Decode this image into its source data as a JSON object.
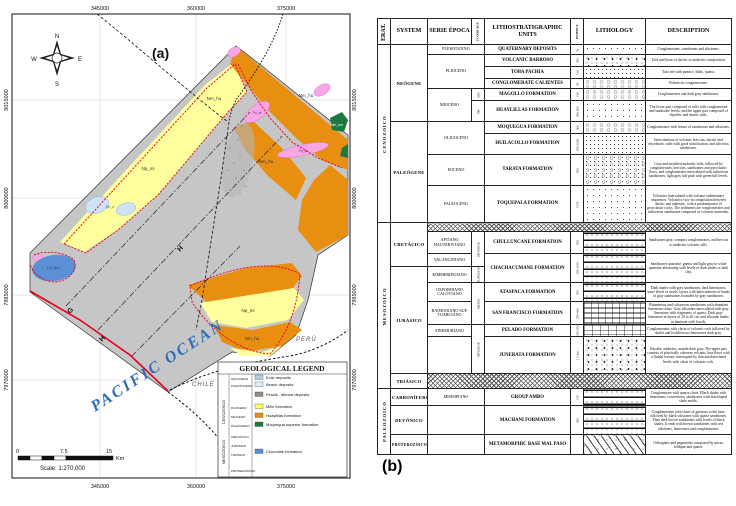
{
  "panel_a": {
    "label": "(a)",
    "compass": {
      "n": "N",
      "s": "S",
      "e": "E",
      "w": "W"
    },
    "coords_top": [
      "345000",
      "360000",
      "375000"
    ],
    "coords_bottom": [
      "345000",
      "360000",
      "375000"
    ],
    "coords_left": [
      "8015000",
      "8000000",
      "7985000",
      "7970000"
    ],
    "coords_right": [
      "8015000",
      "8000000",
      "7985000",
      "7970000"
    ],
    "ocean_label": "PACIFIC OCEAN",
    "chile_label": "CHILE",
    "peru_label": "PERÚ",
    "section_letters": [
      "G",
      "H",
      "H"
    ],
    "map_labels": [
      "Np_mi",
      "Nm_hu",
      "Nm_hu",
      "Nm_hu",
      "Po_ta",
      "Po_ta",
      "TrJ_cho",
      "Qh_e",
      "Np_mi",
      "Nm_hu",
      "Nm_mo"
    ],
    "scale": {
      "zero": "0",
      "mid": "7.5",
      "end": "15",
      "unit": "Km",
      "text": "Scale: 1:270,000"
    },
    "legend": {
      "title": "GEOLOGICAL LEGEND",
      "eras": [
        "CENOZOICO",
        "MESOZOICO",
        "PROTEROZOICO"
      ],
      "series": [
        "HOLOCENO",
        "PLEISTOCENO",
        "PLIOCENO",
        "MIOCENO",
        "PALEÓGENO",
        "CRETÁCICO",
        "JURÁSICO",
        "TRIÁSICO"
      ],
      "entries": [
        {
          "code": "Qh_e",
          "label": "Eolic deposits",
          "color": "#aed4f0"
        },
        {
          "code": "Qh_pl",
          "label": "Beach deposits",
          "color": "#dfeef9"
        },
        {
          "code": "Qpl_al",
          "label": "Fluvial - alluvial deposits",
          "color": "#8f8f8f"
        },
        {
          "code": "Np_mi",
          "label": "Millo formation",
          "color": "#ffff66"
        },
        {
          "code": "Nm_hu",
          "label": "Huaylillas formation",
          "color": "#e88f12"
        },
        {
          "code": "Nm_mo",
          "label": "Moquegua superior formation",
          "color": "#1d7a3c"
        },
        {
          "code": "TrJ_cho",
          "label": "Chocolate formation",
          "color": "#5b8fd6"
        }
      ]
    }
  },
  "panel_b": {
    "label": "(b)",
    "headers": {
      "era": "ERAT.",
      "system": "SYSTEM",
      "serie": "SERIE ÉPOCA",
      "floor": "FLOOR AGE",
      "units": "LITHOSTRATIGRAPHIC UNITS",
      "potency": "POTENCY",
      "lithology": "LITHOLOGY",
      "description": "DESCRIPTION"
    },
    "rows": [
      {
        "era": "CENOZOICO",
        "system": "NEÓGENE",
        "serie": "PLEISTOCENO",
        "unit": "QUATERNARY DEPOSITS",
        "potency": "50",
        "lithology": "dots-sparse",
        "description": "Conglomerates, sandstones and siltstones."
      },
      {
        "serie": "PLIOCENO",
        "unit": "VOLCANIC BARROSO",
        "potency": "300",
        "lithology": "volcanic",
        "description": "Tufa and lavas of dacitic to andesitic composition."
      },
      {
        "unit": "TOBA PACHIA",
        "potency": "100",
        "lithology": "dots",
        "description": "Tufa red with pumice, lithic, quartz."
      },
      {
        "unit": "CONGLOMERATE CALIENTES",
        "potency": "50",
        "lithology": "conglomerate",
        "description": "Polimictic conglomerates."
      },
      {
        "serie": "MIOCENO",
        "floor": "SUP.",
        "unit": "MAGOLLO FORMATION",
        "potency": "100",
        "lithology": "conglomerate",
        "description": "Conglomerates and dark gray sandstones."
      },
      {
        "floor": "INF.",
        "unit": "HUAYLILLAS FORMATION",
        "potency": "300-600",
        "lithology": "dots-sparse",
        "description": "The lower part composed of tuffs with conglomerate and sandstone levels, and the upper part composed of rhyolitic and dacitic tuffs."
      },
      {
        "system": "PALEÓGENE",
        "serie": "OLIGOCENO",
        "unit": "MOQUEGUA FORMATION",
        "potency": "400",
        "lithology": "conglomerate",
        "description": "Conglomerates with lenses of sandstones and siltstones."
      },
      {
        "unit": "HUILACOLLO FORMATION",
        "potency": "600-1000",
        "lithology": "dots",
        "description": "Intercalations of volcanic breccias, dacitic and rhyodacitic tuffs with good stratification, and siliceous sandstones."
      },
      {
        "serie": "EOCENO",
        "unit": "TARATA FORMATION",
        "potency": "900",
        "lithology": "conglomerate-dots",
        "description": "Gray and stratified andesitic tuffs, followed by conglomerates, breccias, sandstones and pyroclastic flows, and conglomerates intercalated with tuffaceous sandstones, light gray tuff pink with green tuff levels."
      },
      {
        "serie": "PALEOCENO",
        "unit": "TOQUEPALA FORMATION",
        "potency": "1570",
        "lithology": "dots-sparse",
        "description": "Volcanics intercalated with volcano-sedimentary sequences. Volcanics vary in composition between dacitic and andesitic, with a predominance of pyroclastic rocks. The sediments are conglomerates and tuffaceous sandstones composed of volcanic materials."
      },
      {
        "era": "MESOZOICO",
        "system": "CRETÁCICO",
        "unconformity": true,
        "lithology": "hatch"
      },
      {
        "serie": "APTIANO HAUTERIVIANO",
        "floor": "INFERIOR",
        "unit": "CHULLUNCANE FORMATION",
        "potency": "500",
        "lithology": "bands-dots",
        "description": "Sandstones gray, compact conglomerates, and breccia to andesitic volcanic sills."
      },
      {
        "serie": "VALANGINIANO",
        "unit": "CHACHACUMANE FORMATION",
        "potency": "300-1100",
        "lithology": "bands-dots",
        "description": "Sandstones quartzite, gneiss and light gray to white quartzite alternating with levels of dark shales or dark clay."
      },
      {
        "system": "JURÁSICO",
        "serie": "KIMMERIDGIANO",
        "floor": "SUPERIOR"
      },
      {
        "serie": "OXFORDIANO CALOVIANO",
        "floor": "MEDIO",
        "unit": "ATASPACA FORMATION",
        "potency": "700",
        "lithology": "bands-dots",
        "description": "Dark shales with gray sandstones, dark limestones, some levels of marls, layers with intercalations of banks of gray sandstones bounded by gray sandstones."
      },
      {
        "serie": "BATHONIANO SUP. TOARCIANO",
        "unit": "SAN FRANCISCO FORMATION",
        "potency": "350-400",
        "lithology": "bricks-bands",
        "description": "Bituminous and calcareous sandstones with abundant limestone clasts. Gray siltstones intercalated with gray limestone with fragments of quartz. Dark gray limestone in layers of 10 to 20 cm, and siltstone banks in laminate with fossils."
      },
      {
        "serie": "SINEMURIANO",
        "floor": "INFERIOR",
        "unit": "PELADO FORMATION",
        "potency": "250-550",
        "lithology": "bricks",
        "description": "Conglomerates with clasts of volcanic rock followed by shales and fossiliferous limestones dark gray."
      },
      {
        "serie": "",
        "unit": "JUNERATA FORMATION",
        "potency": "1.5 km",
        "lithology": "volcanic",
        "description": "Basaltic andesites, mantle dark gray. The upper part consists of physically coherent volcanic lava flows with a fluidal texture, interrupted by thin autobrecciated levels with clasts of volcanic rock."
      },
      {
        "system": "TRIÁSICO",
        "unconformity": true,
        "lithology": "hatch"
      },
      {
        "era": "PALEOZOICO",
        "system": "CARBONÍFERO",
        "serie": "MISISIPIANO",
        "unit": "GROUP AMBO",
        "potency": "150",
        "lithology": "bands-dots",
        "description": "Conglomerate with quartz clasts. Black shales with limestones, concretions, sandstones with brachiopod shale molds."
      },
      {
        "system": "DEVÓNICO",
        "serie": "",
        "unit": "MACHANI FORMATION",
        "potency": "400",
        "lithology": "bands-dots",
        "description": "Conglomerates with clasts of gneisses to the base, followed by black siltstones with quartz sandstones. Then dark brown sandstones with levels of black shales. It ends with brown sandstones with red siltstones, limestones and conglomerates."
      },
      {
        "system": "PROTEROZOICO",
        "serie": "",
        "unit": "METAMORPHIC BASE MAL PASO",
        "potency": "",
        "lithology": "gneiss",
        "description": "Orthogneis and pegmatites composed by micas, feldspar and quartz."
      }
    ]
  },
  "colors": {
    "huaylillas_orange": "#e88f12",
    "millo_yellow": "#ffff9e",
    "quaternary_gray": "#c6c6c6",
    "tarata_pink": "#f7a6e6",
    "chocolate_blue": "#5b8fd6",
    "moquegua_green": "#1d7a3c",
    "boundary_red": "#e8001d",
    "ocean_blue": "#2e6db4"
  }
}
